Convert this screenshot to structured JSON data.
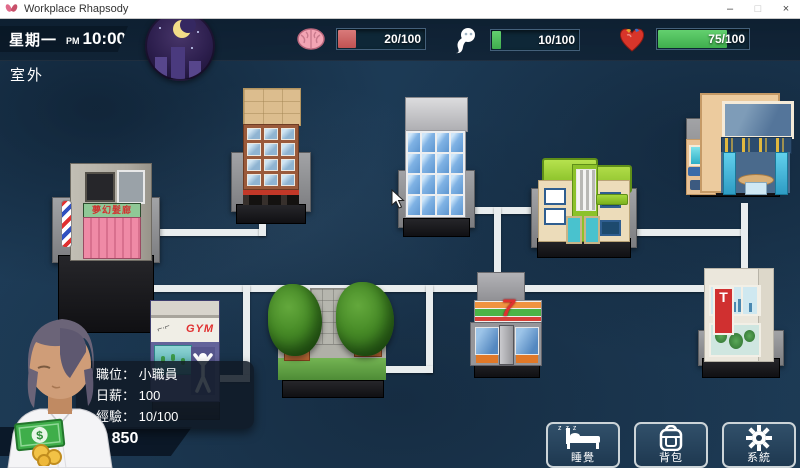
{
  "window": {
    "title": "Workplace Rhapsody",
    "controls": {
      "minimize": "–",
      "maximize": "□",
      "close": "×"
    }
  },
  "hud": {
    "day": "星期一",
    "meridiem": "PM",
    "time": "10:00",
    "location": "室外",
    "time_of_day": "night-moon",
    "stats": [
      {
        "name": "brain",
        "icon": "brain-icon",
        "value": "20/100",
        "pct": "20%",
        "fill_color": "#c05252"
      },
      {
        "name": "spirit",
        "icon": "spirit-icon",
        "value": "10/100",
        "pct": "10%",
        "fill_color": "#3fae4d"
      },
      {
        "name": "heart",
        "icon": "heart-icon",
        "value": "75/100",
        "pct": "75%",
        "fill_color": "#3fae4d"
      }
    ]
  },
  "player": {
    "position_label": "職位：",
    "position_value": "小職員",
    "wage_label": "日薪：",
    "wage_value": "100",
    "exp_label": "經驗：",
    "exp_value": "10/100",
    "money": "850",
    "money_icon": "cash-coins-icon"
  },
  "actions": [
    {
      "id": "sleep",
      "label": "睡覺",
      "icon": "bed-icon",
      "zzz": "z z z"
    },
    {
      "id": "bag",
      "label": "背包",
      "icon": "backpack-icon"
    },
    {
      "id": "system",
      "label": "系統",
      "icon": "gear-icon"
    }
  ],
  "map": {
    "buildings": [
      {
        "id": "hair-salon",
        "sign": "夢幻髮廊"
      },
      {
        "id": "apartment"
      },
      {
        "id": "office-tower"
      },
      {
        "id": "green-house"
      },
      {
        "id": "restaurant"
      },
      {
        "id": "gym",
        "sign": "GYM"
      },
      {
        "id": "park"
      },
      {
        "id": "convenience-store",
        "sign": "7"
      },
      {
        "id": "drugstore",
        "sign": "T"
      }
    ]
  }
}
